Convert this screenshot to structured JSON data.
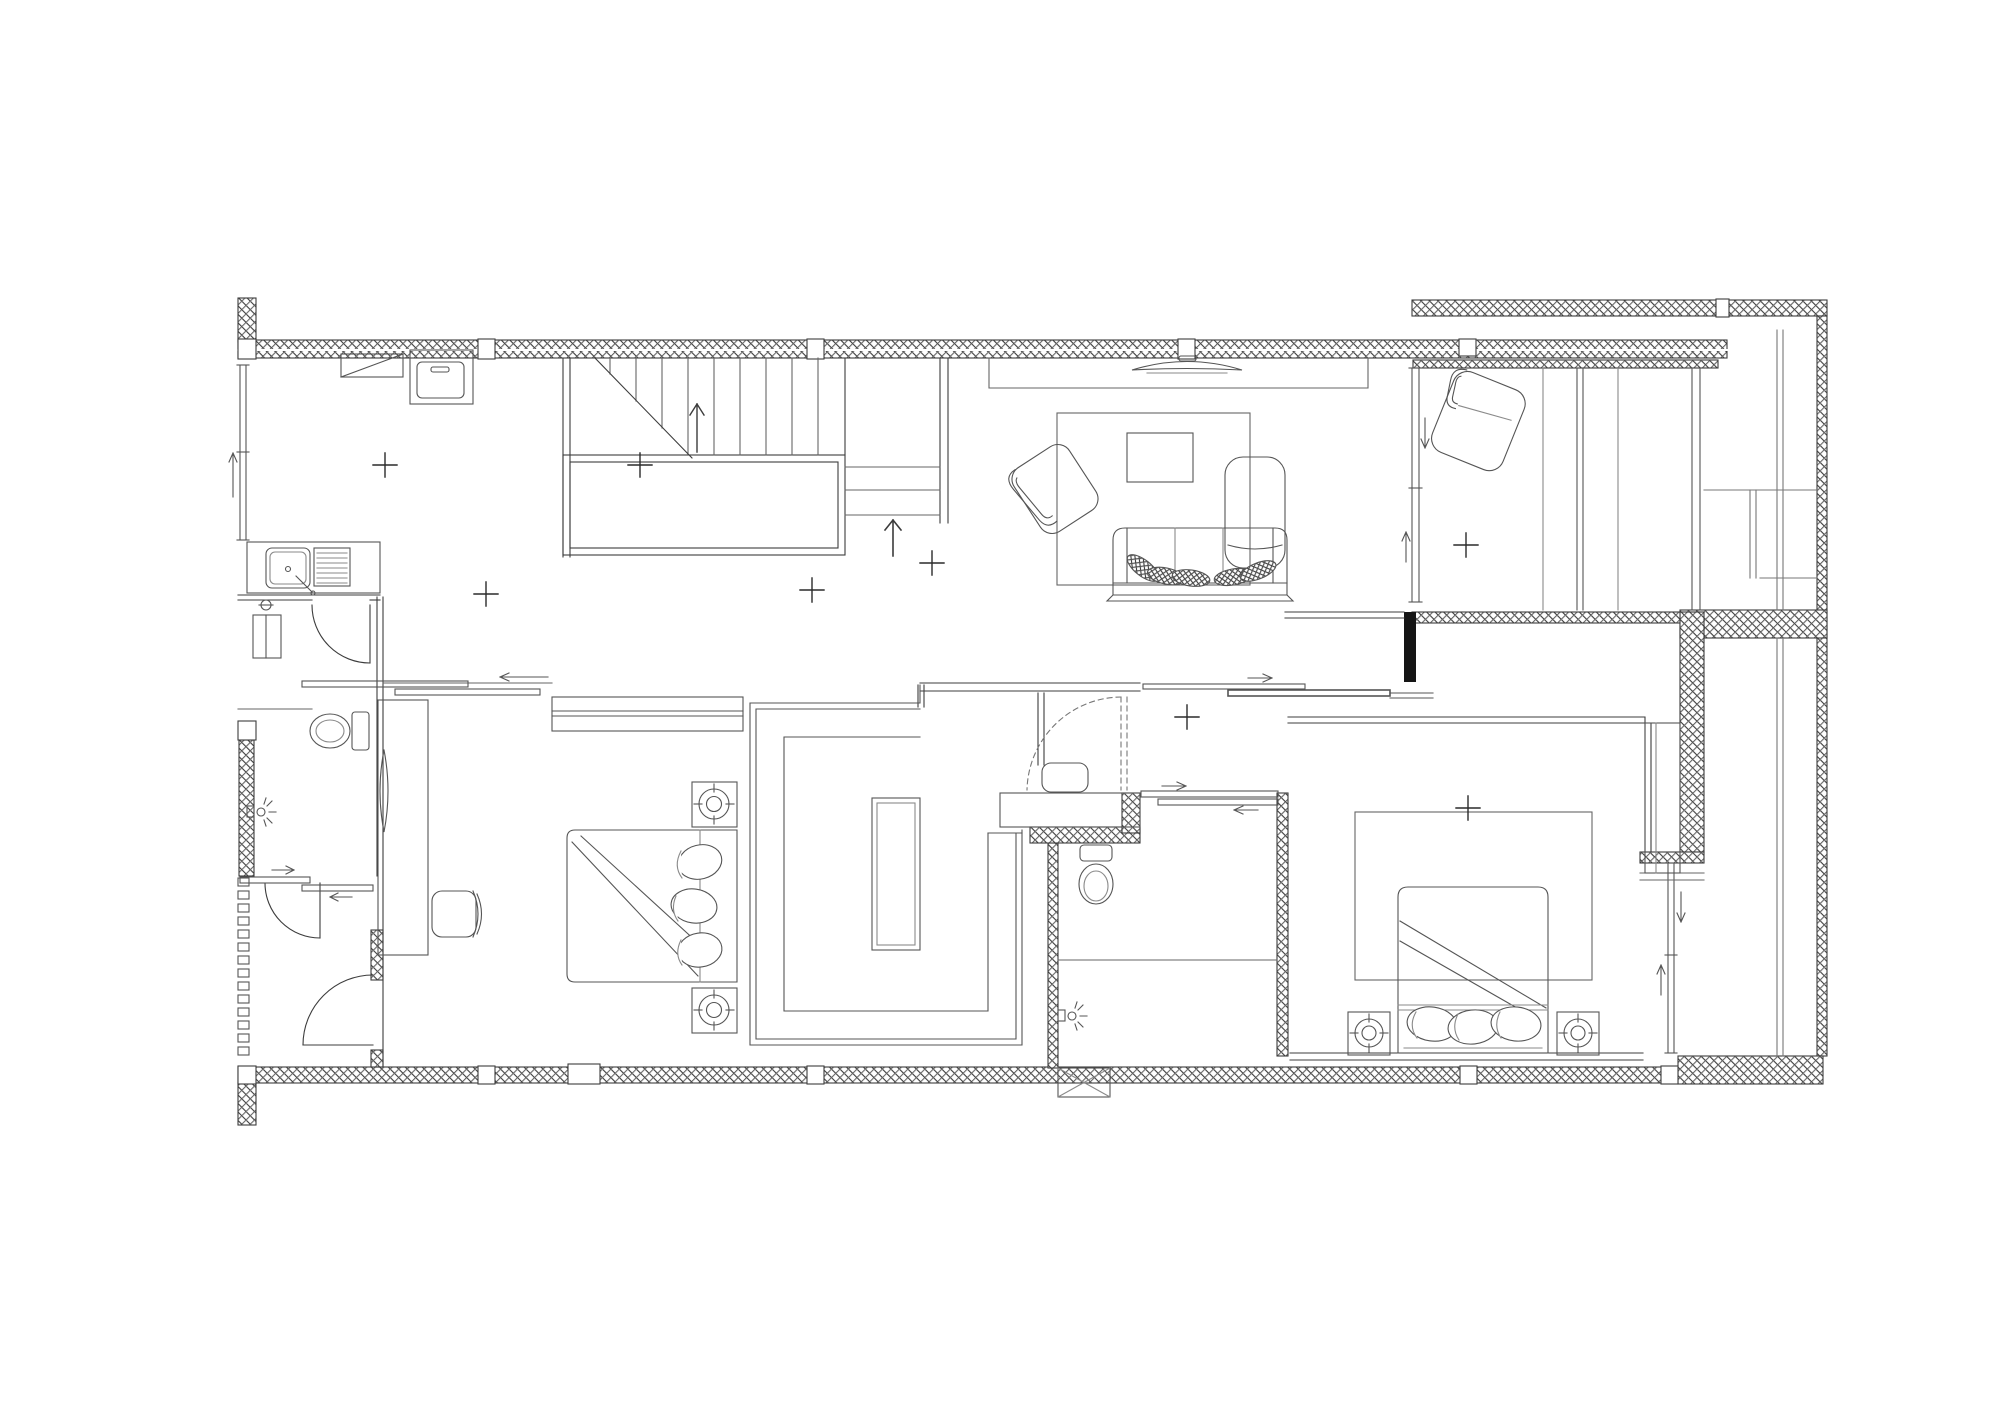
{
  "meta": {
    "kind": "architectural-floor-plan",
    "level": "upper-floor",
    "background": "#ffffff",
    "visible_text": []
  },
  "colors": {
    "wall_outline": "#3c3c3c",
    "partition_line": "#4a4a4a",
    "furniture_line": "#5a5a5a",
    "light_line": "#8a8a8a",
    "hatch_line": "#9b9b9b",
    "solid_column": "#151515",
    "paper": "#ffffff"
  },
  "rooms": [
    {
      "id": "utility-laundry",
      "side": "top-left"
    },
    {
      "id": "bathroom-1",
      "side": "left"
    },
    {
      "id": "drying-strip",
      "side": "bottom-left"
    },
    {
      "id": "bedroom-1",
      "side": "bottom-center-left"
    },
    {
      "id": "walk-in-closet",
      "side": "bottom-center"
    },
    {
      "id": "staircase",
      "side": "top-center"
    },
    {
      "id": "hall",
      "side": "center"
    },
    {
      "id": "living-room",
      "side": "top-center-right"
    },
    {
      "id": "corridor",
      "side": "center-right"
    },
    {
      "id": "bathroom-2",
      "side": "bottom-center-right"
    },
    {
      "id": "master-bedroom",
      "side": "bottom-right"
    },
    {
      "id": "balcony",
      "side": "top-right"
    },
    {
      "id": "service-shaft",
      "side": "far-right"
    }
  ],
  "fixtures": [
    "washer",
    "counter-cabinet",
    "kitchen-sink",
    "vanity-cabinet",
    "toilet-1",
    "shower-head-1",
    "full-length-mirror",
    "desk",
    "desk-chair",
    "bed-1",
    "pillows",
    "speaker-stands",
    "wardrobe-sliding",
    "closet-island",
    "vanity-2",
    "toilet-2",
    "shower-head-2",
    "tv",
    "tv-ledge",
    "rug-living",
    "coffee-table",
    "armchair",
    "lounge-chair-tall",
    "sofa",
    "sofa-cushions",
    "rug-master",
    "bed-master",
    "wardrobe-master",
    "balcony-lounge-chair",
    "floor-vent-window"
  ],
  "stairs": {
    "upper_flight_treads": 9,
    "lower_flight_treads": 3,
    "up_arrows": 2,
    "break_line": true,
    "landing": true
  },
  "doors": {
    "swing": 4,
    "dashed_swing": 1,
    "sliding_sets": 4,
    "window_slides": 3
  },
  "survey_cross_markers": [
    [
      385,
      465
    ],
    [
      640,
      465
    ],
    [
      486,
      594
    ],
    [
      812,
      590
    ],
    [
      932,
      563
    ],
    [
      1187,
      717
    ],
    [
      1466,
      545
    ],
    [
      1468,
      808
    ]
  ]
}
